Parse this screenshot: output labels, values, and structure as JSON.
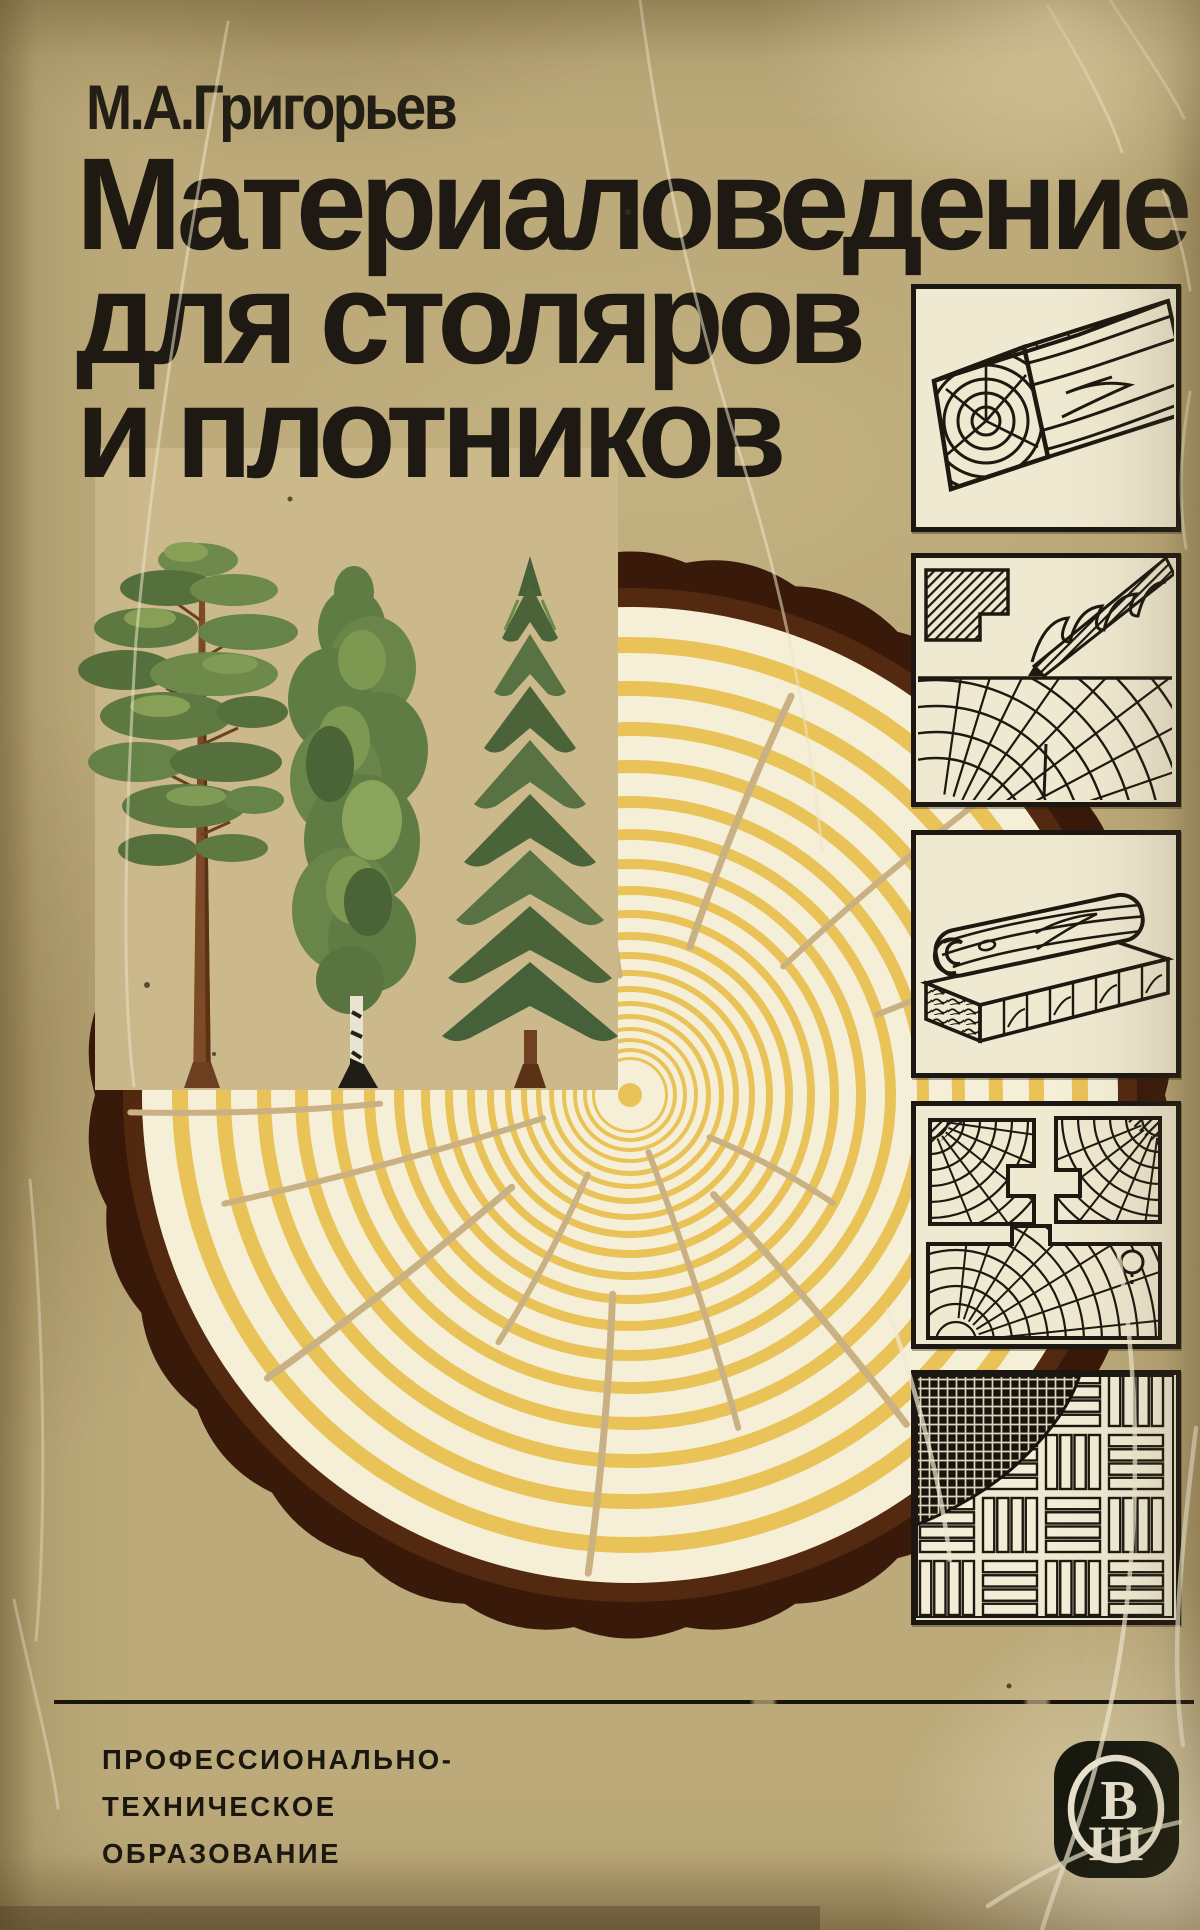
{
  "page": {
    "author": "М.А.Григорьев",
    "title_lines": [
      "Материаловедение",
      "для столяров",
      "и плотников"
    ],
    "footer_series": [
      "ПРОФЕССИОНАЛЬНО-",
      "ТЕХНИЧЕСКОЕ",
      "ОБРАЗОВАНИЕ"
    ],
    "publisher": {
      "logo_top": "В",
      "logo_bottom": "Ш",
      "logo_icon": "vysshaya-shkola-publisher-logo"
    }
  },
  "colors": {
    "paper": "#bcaa7a",
    "ink": "#1e1a13",
    "panel_paper": "#f0e9d1",
    "panel_ink": "#1d1911"
  },
  "artwork": {
    "pith": [
      630,
      1095
    ],
    "outer_radius": 535,
    "bark_lobes": 30,
    "bark_bump": 20,
    "rings_start": 488,
    "ring_pairs": [
      [
        30,
        16
      ],
      [
        28,
        15
      ],
      [
        26,
        14
      ],
      [
        24,
        13
      ],
      [
        23,
        12
      ],
      [
        21,
        11
      ],
      [
        19,
        10
      ],
      [
        17,
        9
      ],
      [
        15,
        8
      ],
      [
        14,
        8
      ],
      [
        12,
        7
      ],
      [
        11,
        6
      ],
      [
        10,
        6
      ],
      [
        9,
        5
      ],
      [
        8,
        5
      ],
      [
        8,
        4
      ],
      [
        7,
        4
      ],
      [
        6,
        4
      ],
      [
        5,
        3
      ]
    ],
    "cracks": [
      [
        -95,
        120,
        300,
        6
      ],
      [
        -99,
        330,
        470,
        6
      ],
      [
        -68,
        160,
        430,
        7
      ],
      [
        -40,
        200,
        470,
        6
      ],
      [
        -18,
        260,
        440,
        6
      ],
      [
        5,
        300,
        450,
        5
      ],
      [
        28,
        90,
        230,
        6
      ],
      [
        50,
        130,
        430,
        7
      ],
      [
        72,
        60,
        350,
        6
      ],
      [
        95,
        200,
        480,
        7
      ],
      [
        118,
        90,
        280,
        6
      ],
      [
        142,
        150,
        460,
        7
      ],
      [
        165,
        90,
        420,
        6
      ],
      [
        178,
        250,
        500,
        6
      ]
    ],
    "colors": {
      "bark_dark": "#38190a",
      "bark": "#53290f",
      "ring_cream": "#f6efd8",
      "ring_yellow": "#e9c258",
      "crack": "#c9b183",
      "square": "#cbb98c"
    },
    "tree_icons": [
      "pine-tree-illustration",
      "birch-tree-illustration",
      "spruce-tree-illustration"
    ],
    "panel_icons": [
      "squared-timber-beam-sketch",
      "knife-cutting-end-grain-sketch",
      "planed-board-and-glued-panel-sketch",
      "profiled-joinery-sections-sketch",
      "parquet-basket-weave-sketch"
    ]
  }
}
